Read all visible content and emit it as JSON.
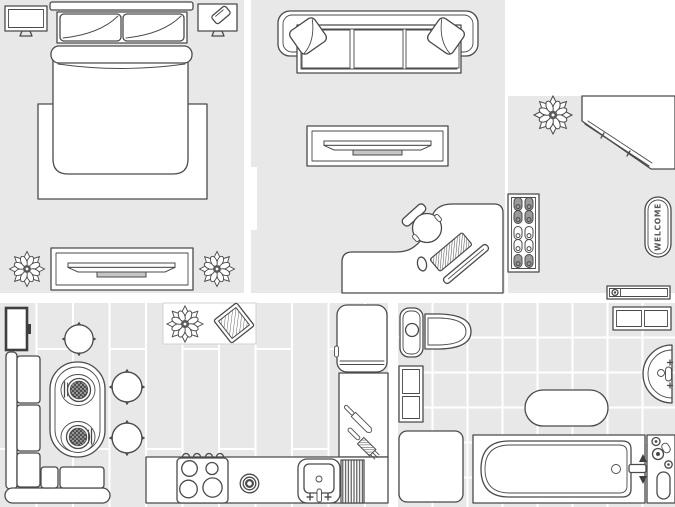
{
  "app": {
    "type": "apartment-floor-plan"
  },
  "colors": {
    "floor": "#e8e8e8",
    "wall_gap": "#ffffff",
    "outline": "#4a4a4a",
    "dark_fill": "#8f8f8f",
    "tv_base": "#c6c6c6",
    "plant_center": "#5a5a5a"
  },
  "bedroom": {
    "items": [
      "tv-left",
      "bed",
      "pillows",
      "duvet",
      "bed-frame",
      "nightstand-tv-with-phone",
      "media-console-tv",
      "potted-plant-left",
      "potted-plant-right"
    ]
  },
  "living_room": {
    "items": [
      "sofa",
      "throw-pillow-left",
      "throw-pillow-right",
      "tv-stand",
      "corner-desk",
      "office-chair",
      "keyboard",
      "monitor",
      "mouse"
    ]
  },
  "entrance": {
    "welcome_mat_text": "WELCOME",
    "items": [
      "potted-plant",
      "corner-wardrobe",
      "shoe-rack",
      "welcome-mat",
      "wall-shelf"
    ]
  },
  "kitchen": {
    "items": [
      "wall-tv",
      "corner-bench",
      "oval-dining-table",
      "place-setting-top",
      "place-setting-bottom",
      "stool-top",
      "stool-right-upper",
      "stool-right-lower",
      "rug-with-plant",
      "fridge",
      "counter",
      "stove",
      "single-burner",
      "sink",
      "drainboard",
      "knife",
      "fork"
    ]
  },
  "bathroom": {
    "items": [
      "toilet",
      "storage-cabinet",
      "towel-shelf",
      "wall-sink",
      "oval-rug",
      "shower-mat",
      "bathtub",
      "tub-faucet",
      "shower-controls"
    ]
  }
}
